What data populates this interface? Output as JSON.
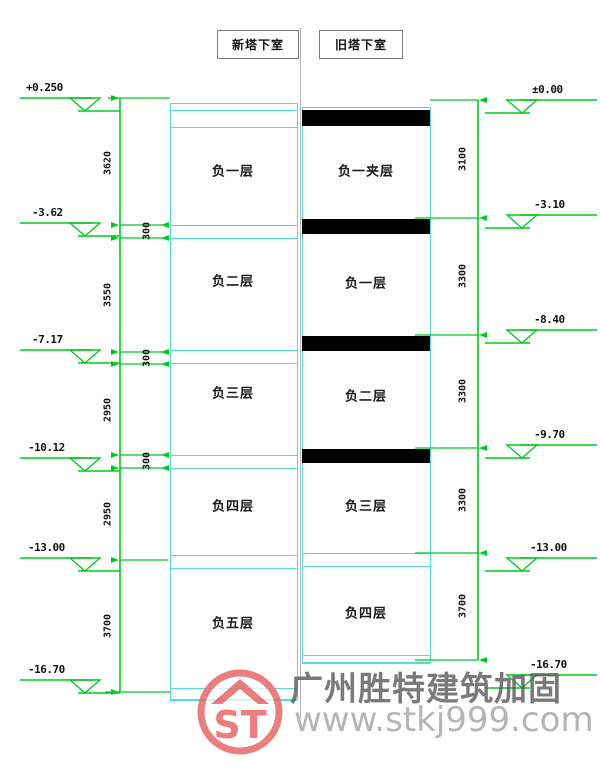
{
  "title_boxes": {
    "left": "新塔下室",
    "right": "旧塔下室"
  },
  "left_section": {
    "floors": [
      "负一层",
      "负二层",
      "负三层",
      "负四层",
      "负五层"
    ],
    "elevations": [
      "+0.250",
      "-3.62",
      "-7.17",
      "-10.12",
      "-13.00",
      "-16.70"
    ],
    "dims": [
      "3620",
      "300",
      "3550",
      "300",
      "2950",
      "300",
      "2950",
      "3700"
    ]
  },
  "right_section": {
    "floors": [
      "负一夹层",
      "负一层",
      "负二层",
      "负三层",
      "负四层"
    ],
    "elevations": [
      "±0.00",
      "-3.10",
      "-8.40",
      "-9.70",
      "-13.00",
      "-16.70"
    ],
    "dims": [
      "3100",
      "3300",
      "3300",
      "3300",
      "3700"
    ]
  },
  "watermark": {
    "company": "广州胜特建筑加固",
    "website": "www.stkj999.com",
    "logo_monogram": "ST"
  },
  "colors": {
    "dimension_green": "#00c824",
    "structure_cyan": "#58d8d8",
    "slab_black": "#000000",
    "watermark_red": "#e87070",
    "watermark_gray": "#5c5c5c",
    "watermark_light_gray": "#a8a8a8"
  }
}
